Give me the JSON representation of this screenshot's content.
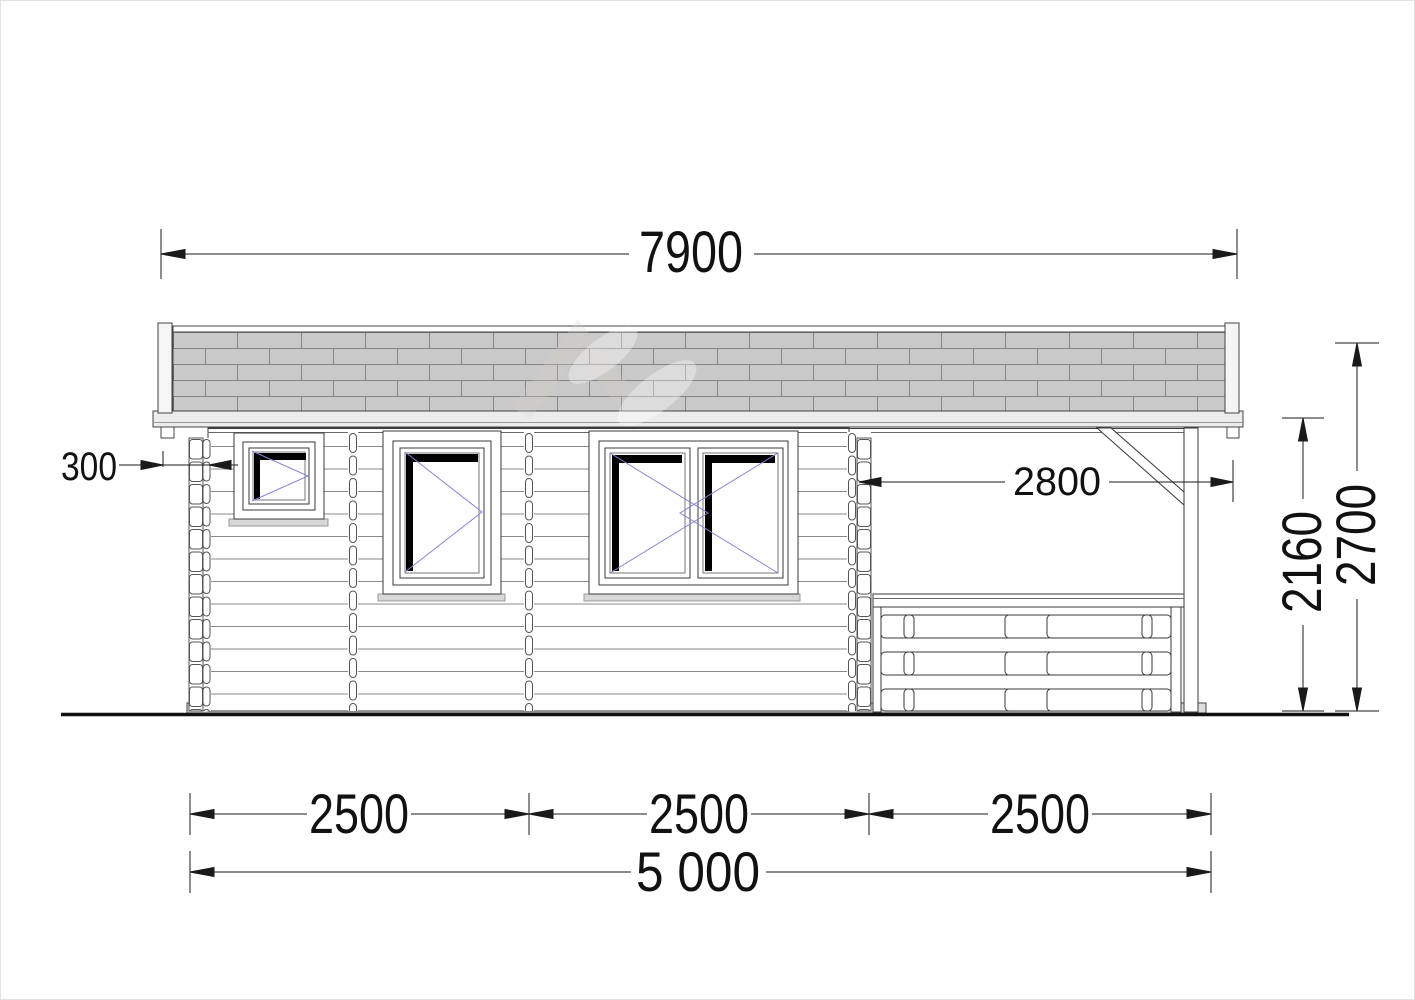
{
  "drawing": {
    "type": "log-cabin side elevation, technical dimension drawing",
    "dimensions": {
      "total_width": "7900",
      "left_overhang": "300",
      "porch_width": "2800",
      "wall_height": "2160",
      "total_height": "2700",
      "bay1": "2500",
      "bay2": "2500",
      "bay3": "2500",
      "base_width": "5 000"
    },
    "colors": {
      "shingle_fill": "#c9c9c9",
      "shingle_line": "#858585",
      "fascia_fill": "#ececec",
      "base_fill": "#dedede",
      "outline": "#3a3a3a",
      "log_line": "#8a8a8a",
      "dimension_line": "#1a1a1a",
      "window_opening_symbol": "#8585d6",
      "sash_black": "#000000"
    }
  }
}
